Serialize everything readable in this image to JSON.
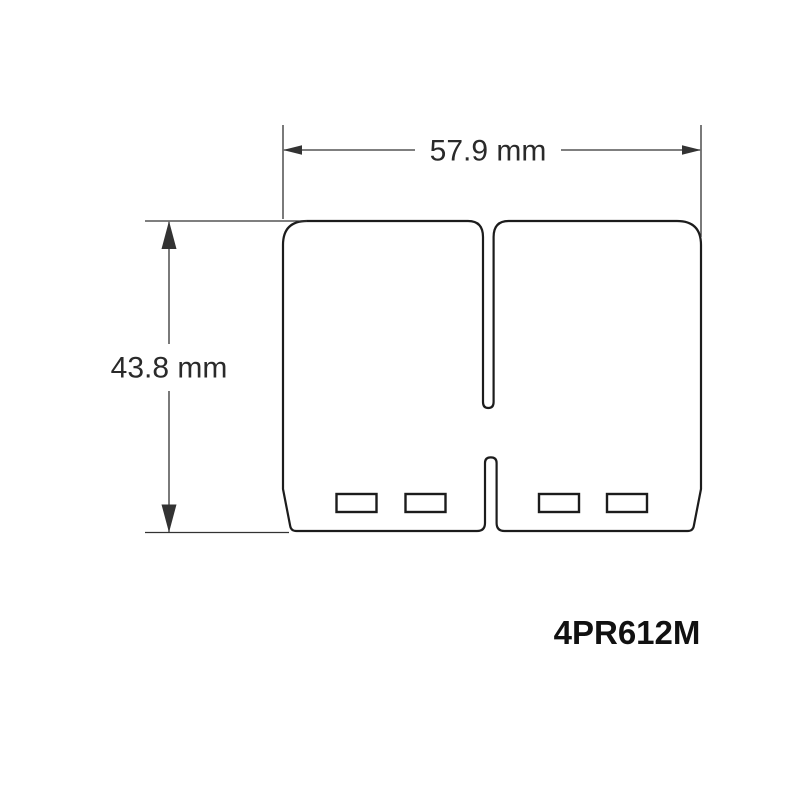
{
  "drawing": {
    "part_number": "4PR612M",
    "width_dimension": {
      "label": "57.9 mm",
      "value_mm": 57.9
    },
    "height_dimension": {
      "label": "43.8 mm",
      "value_mm": 43.8
    }
  },
  "style": {
    "background": "#ffffff",
    "outline_color": "#1c1c1c",
    "dimension_color": "#333333",
    "text_color": "#2a2a2a",
    "part_color": "#111111"
  }
}
